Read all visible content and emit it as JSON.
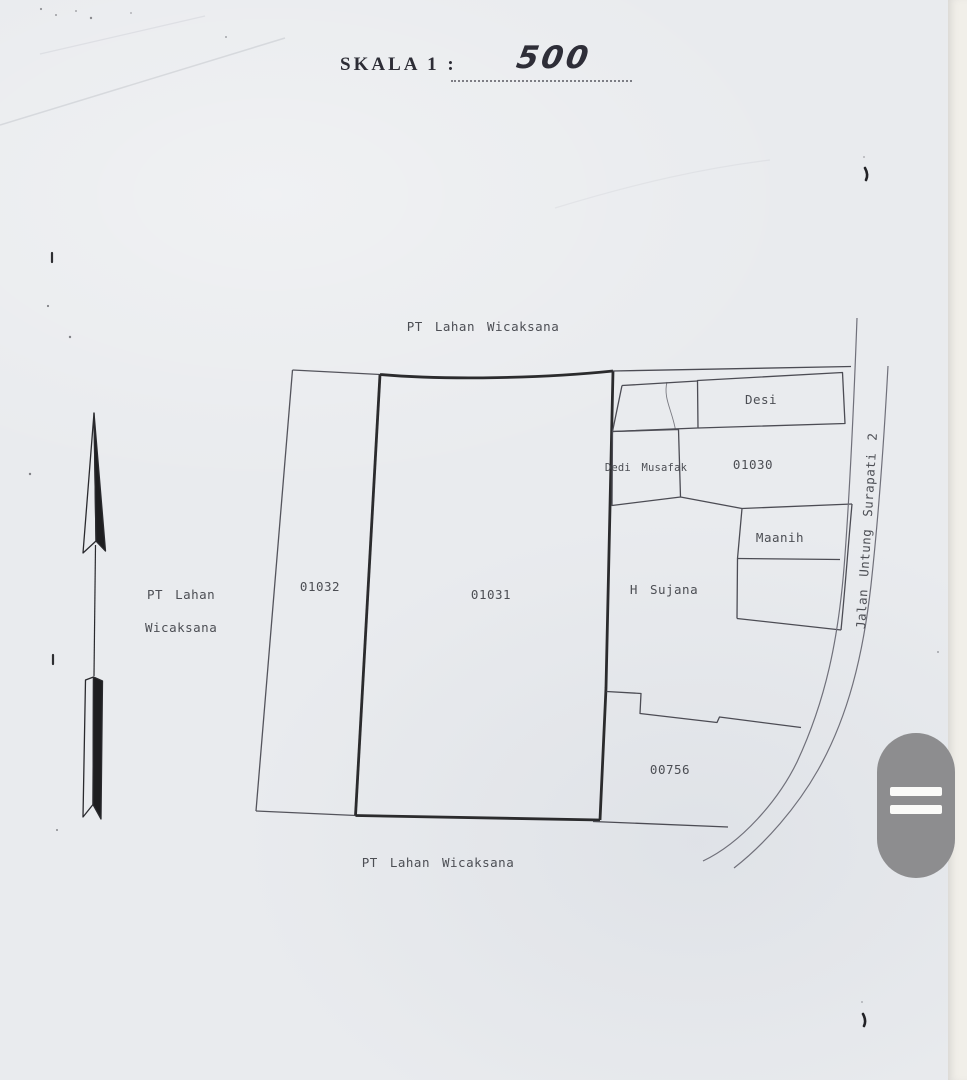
{
  "document": {
    "scale_label": "SKALA 1 :",
    "scale_value": "500"
  },
  "map": {
    "boundary_owner_top": "PT Lahan Wicaksana",
    "boundary_owner_left": {
      "line1": "PT Lahan",
      "line2": "Wicaksana"
    },
    "boundary_owner_bottom": "PT Lahan Wicaksana",
    "road_name": "Jalan Untung Surapati 2",
    "parcels": [
      {
        "label": "01032"
      },
      {
        "label": "01031"
      },
      {
        "label": "01030"
      },
      {
        "label": "00756"
      },
      {
        "label": "Desi"
      },
      {
        "label": "Dedi Musafak"
      },
      {
        "label": "Maanih"
      },
      {
        "label": "H Sujana"
      }
    ],
    "icons": {
      "north_arrow": "north-arrow-icon",
      "handle": "double-bar-handle-icon"
    }
  },
  "colors": {
    "paper": "#e9ebee",
    "paper_edge": "#f1efe9",
    "line_heavy": "#2b2b2d",
    "line_thin": "#54545c",
    "road_line": "#70707a",
    "handle_bg": "#8d8d8f",
    "handle_bar": "#fafaf8"
  }
}
